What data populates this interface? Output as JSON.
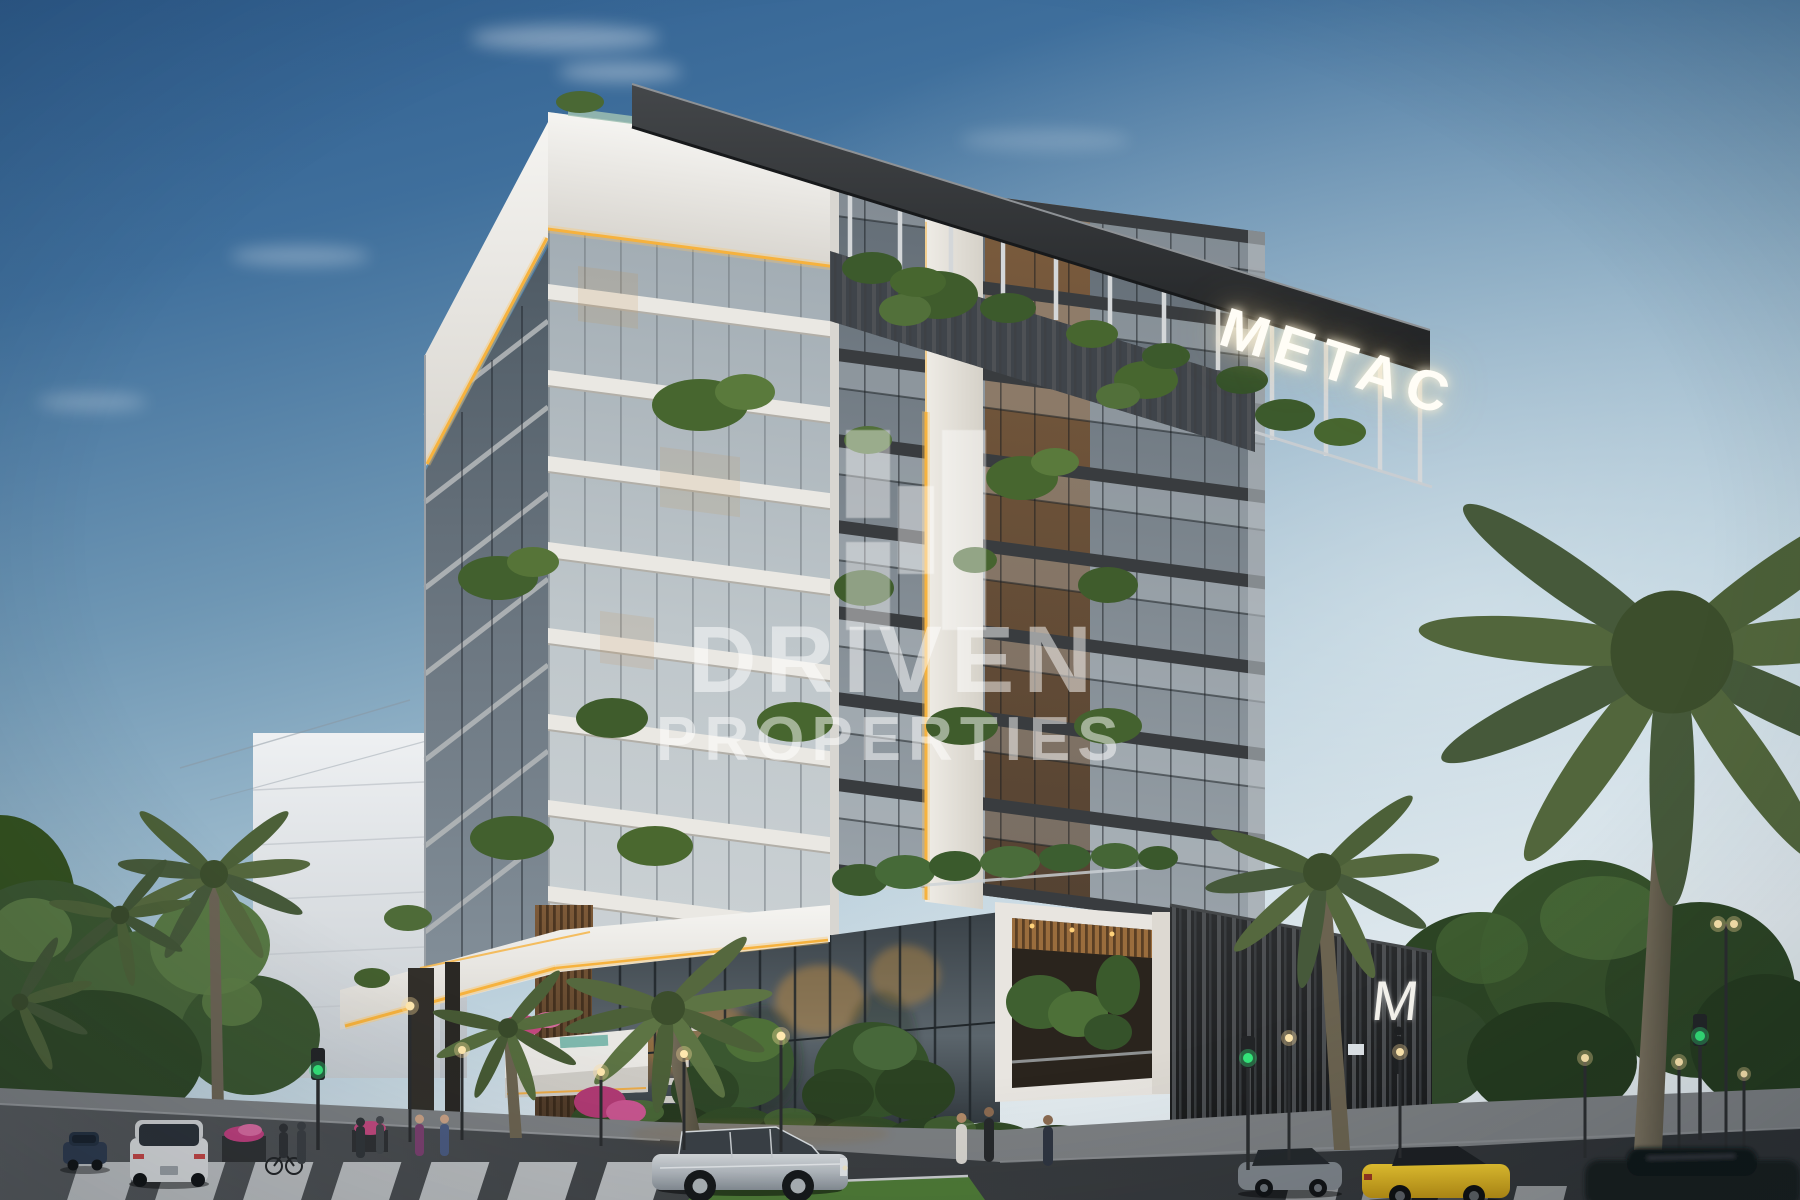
{
  "image_type": "architectural-exterior-rendering",
  "watermark": {
    "logo": "driven-properties-block-monogram",
    "line1": "DRIVEN",
    "line2": "PROPERTIES",
    "color": "#ffffff"
  },
  "signs": {
    "rooftop": "METAC",
    "podium_monogram": "M",
    "color": "#ffffff"
  },
  "scene": {
    "setting": "modern luxury apartment building at dusk with warm LED accent lighting",
    "sky_top_color": "#2e5d8f",
    "sky_horizon_color": "#e2eaee",
    "led_accent_color": "#f6b23e",
    "wood_accent_color": "#8a6238",
    "traffic_light_state": "green",
    "vehicles": [
      "dark SUV",
      "white SUV",
      "silver luxury sedan",
      "grey coupe",
      "yellow sports car",
      "dark foreground car"
    ]
  }
}
